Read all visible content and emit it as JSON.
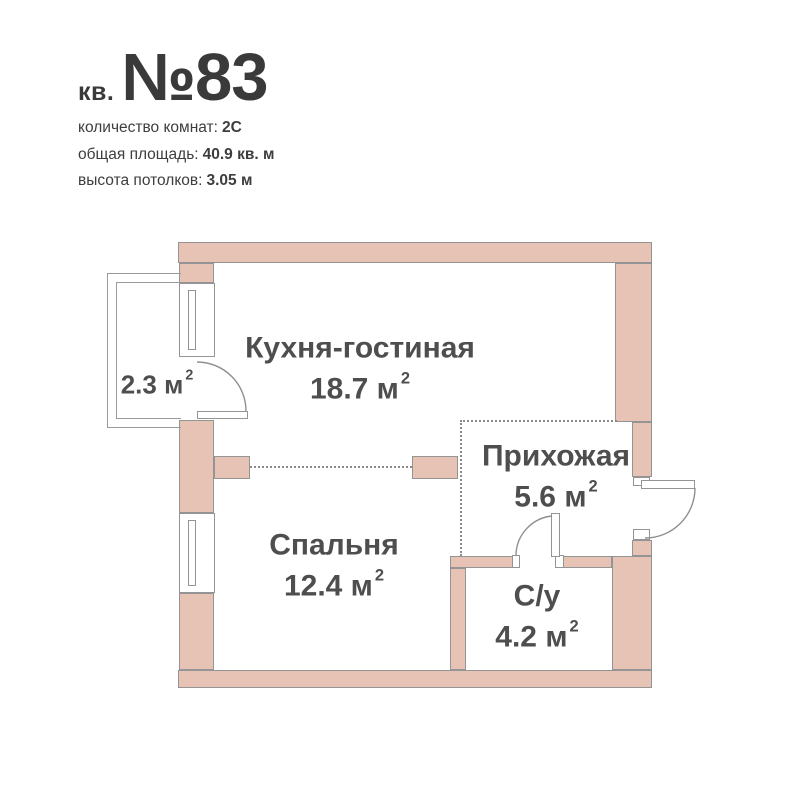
{
  "header": {
    "unit_prefix": "кв.",
    "unit_number": "№83",
    "details": [
      {
        "label": "количество комнат:",
        "value": "2С"
      },
      {
        "label": "общая площадь:",
        "value": "40.9 кв. м"
      },
      {
        "label": "высота потолков:",
        "value": "3.05 м"
      }
    ]
  },
  "plan": {
    "rooms": [
      {
        "id": "kitchen-living",
        "name": "Кухня-гостиная",
        "area": "18.7 м"
      },
      {
        "id": "hallway",
        "name": "Прихожая",
        "area": "5.6 м"
      },
      {
        "id": "bedroom",
        "name": "Спальня",
        "area": "12.4 м"
      },
      {
        "id": "bathroom",
        "name": "С/у",
        "area": "4.2 м"
      },
      {
        "id": "balcony",
        "name": "",
        "area": "2.3 м"
      }
    ],
    "area_superscript": "2",
    "colors": {
      "wall_fill": "#e7c3b5",
      "wall_stroke": "#949494",
      "dotted_line": "#8a8a8a",
      "label_text": "#4e4e4e",
      "header_text": "#3a3a3a"
    }
  }
}
